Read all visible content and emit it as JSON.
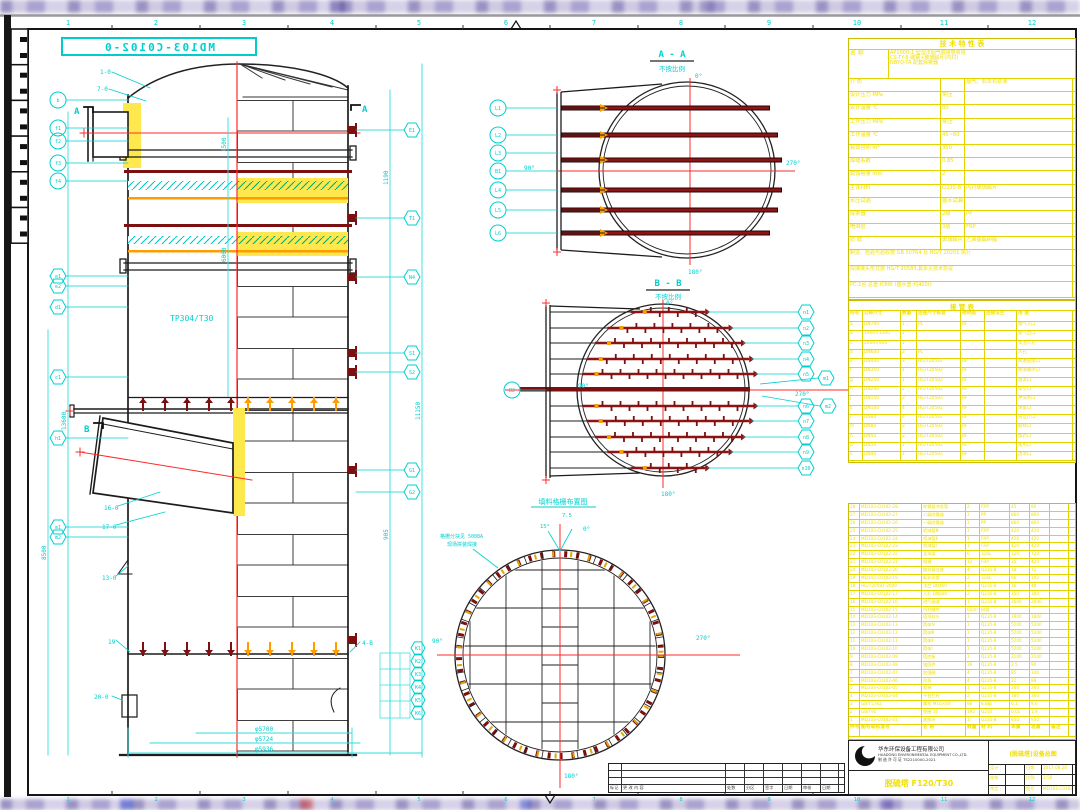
{
  "sheet": {
    "stamp": "MD103-C0102-0",
    "grid_numbers": [
      "1",
      "2",
      "3",
      "4",
      "5",
      "6",
      "7",
      "8",
      "9",
      "10",
      "11",
      "12"
    ]
  },
  "tower": {
    "material_label": "TP304/T30",
    "mark_a": "A",
    "mark_b": "B",
    "callouts": {
      "c10": "1-0",
      "c70": "7-0",
      "c16": "16-0",
      "c17": "17-0",
      "c13": "13-0",
      "c20": "20-0",
      "c19": "19",
      "c4b": "4-B"
    },
    "dims": {
      "d1": "φ5700",
      "d2": "φ5724",
      "d3": "φ5936",
      "l1": "1500",
      "l2": "6000",
      "l3": "8500",
      "l4": "13600",
      "r1": "1190",
      "r2": "11150",
      "r3": "905"
    },
    "left_balloons": [
      "b",
      "f1",
      "f2",
      "f3",
      "f4",
      "e1",
      "e2",
      "d1",
      "c1",
      "h1",
      "m1",
      "m2"
    ],
    "right_balloons": [
      "E1",
      "T1",
      "N4",
      "S1",
      "S2",
      "G1",
      "G2"
    ],
    "bottom_balloons": [
      "K1",
      "K2",
      "K3",
      "K4",
      "K5",
      "K6"
    ]
  },
  "aa": {
    "title": "A - A",
    "subtitle": "不按比例",
    "a0": "0°",
    "a90": "90°",
    "a180": "180°",
    "a270": "270°",
    "balloons": [
      "L1",
      "L2",
      "L3",
      "B1",
      "L4",
      "L5",
      "L6"
    ]
  },
  "bb": {
    "title": "B - B",
    "subtitle": "不按比例",
    "a0": "0°",
    "a90": "90°",
    "a180": "180°",
    "a270": "270°",
    "left_balloon": "B2",
    "balloons": [
      "n1",
      "n2",
      "n3",
      "n4",
      "n5",
      "n6",
      "n7",
      "n8",
      "n9",
      "n10"
    ],
    "side_balloons": [
      "m1",
      "m2"
    ]
  },
  "plan": {
    "title": "填料格栅布置图",
    "a0": "0°",
    "a90": "90°",
    "a180": "180°",
    "a270": "270°",
    "a15": "15°",
    "a75": "7.5",
    "note1": "格栅分块见 5008A",
    "note2": "现场拼装焊接"
  },
  "spec": {
    "title": "技 术 特 性 表",
    "name_label": "名 称",
    "name_lines": [
      "AP1000-1 型湿法烟气脱硫吸收塔",
      "CS-TY-8 碳钢+玻璃鳞片(内衬)",
      "NBYQ-TA 配套除雾器"
    ],
    "rows": [
      [
        "介 质",
        "",
        "烟气、石灰石浆液"
      ],
      [
        "设计压力 MPa",
        "常压",
        ""
      ],
      [
        "设计温度 ℃",
        "80",
        ""
      ],
      [
        "工作压力 MPa",
        "常压",
        ""
      ],
      [
        "工作温度 ℃",
        "45~60",
        ""
      ],
      [
        "有效容积 m³",
        "350",
        ""
      ],
      [
        "焊缝系数",
        "0.85",
        ""
      ],
      [
        "腐蚀裕量 mm",
        "2",
        ""
      ],
      [
        "主体材料",
        "Q235-B",
        "内衬玻璃鳞片"
      ],
      [
        "水压试验",
        "盛水试漏",
        ""
      ],
      [
        "除雾器",
        "2级",
        "PP"
      ],
      [
        "喷淋层",
        "3层",
        "FRP"
      ],
      [
        "防 腐",
        "玻璃鳞片",
        "乙烯基酯树脂"
      ]
    ],
    "footers": [
      "制造、检验与验收按 GB 50764 及 HG/T 20201 执行",
      "焊接接头形式按 HG/T 20583,其余见技术协议",
      "PC:1台  总重:约86t  (盛水重:约420t)"
    ]
  },
  "noz": {
    "title": "接 管 表",
    "headers": [
      "符号",
      "公称尺寸",
      "数量",
      "连接尺寸标准",
      "密封面",
      "连接法兰",
      "用 途"
    ],
    "rows": [
      [
        "a",
        "DN700",
        "1",
        "PL",
        "RF",
        "",
        "烟气入口"
      ],
      [
        "b",
        "1900×1300",
        "1",
        "",
        "",
        "",
        "烟气出口"
      ],
      [
        "c",
        "2000×900",
        "1",
        "",
        "",
        "",
        "浆池人孔"
      ],
      [
        "d",
        "DN600",
        "2",
        "PL",
        "",
        "",
        "人孔"
      ],
      [
        "e",
        "DN400",
        "3",
        "HG/T20592",
        "RF",
        "",
        "喷淋层接口"
      ],
      [
        "f",
        "DN350",
        "1",
        "HG/T20592",
        "RF",
        "",
        "浆液循环口"
      ],
      [
        "g",
        "DN250",
        "1",
        "HG/T20592",
        "RF",
        "",
        "溢流口"
      ],
      [
        "h",
        "DN200",
        "2",
        "HG/T20592",
        "RF",
        "",
        "排空口"
      ],
      [
        "j",
        "DN150",
        "2",
        "HG/T20592",
        "RF",
        "",
        "冲洗水口"
      ],
      [
        "k",
        "DN100",
        "4",
        "HG/T20592",
        "RF",
        "",
        "测量口"
      ],
      [
        "l",
        "DN80",
        "4",
        "HG/T20592",
        "RF",
        "",
        "液位计口"
      ],
      [
        "m",
        "DN80",
        "2",
        "HG/T20592",
        "RF",
        "",
        "取样口"
      ],
      [
        "n",
        "DN50",
        "2",
        "HG/T20592",
        "RF",
        "",
        "加药口"
      ],
      [
        "p",
        "DN50",
        "1",
        "HG/T20592",
        "RF",
        "",
        "备用口"
      ],
      [
        "s",
        "DN40",
        "1",
        "HG/T20592",
        "RF",
        "",
        "放净口"
      ]
    ]
  },
  "bom": {
    "headers": [
      "件号",
      "图号或标准号",
      "名 称",
      "数量",
      "材 料",
      "单重",
      "总重",
      "备注"
    ],
    "rows": [
      [
        "28",
        "MD103-C0102-28",
        "除雾器冲洗管",
        "2",
        "FRP",
        "45",
        "90",
        ""
      ],
      [
        "27",
        "MD103-C0102-27",
        "二级除雾器",
        "1",
        "PP",
        "860",
        "860",
        ""
      ],
      [
        "26",
        "MD103-C0102-26",
        "一级除雾器",
        "1",
        "PP",
        "860",
        "860",
        ""
      ],
      [
        "25",
        "MD103-C0102-25",
        "喷淋管Ⅲ",
        "1",
        "FRP",
        "420",
        "420",
        ""
      ],
      [
        "24",
        "MD103-C0102-24",
        "喷淋管Ⅱ",
        "1",
        "FRP",
        "420",
        "420",
        ""
      ],
      [
        "23",
        "MD103-C0102-23",
        "喷淋管Ⅰ",
        "1",
        "FRP",
        "420",
        "420",
        ""
      ],
      [
        "22",
        "MD103-C0102-22",
        "支承梁",
        "6",
        "316L",
        "120",
        "720",
        ""
      ],
      [
        "21",
        "MD103-C0102-21",
        "格栅",
        "12",
        "FRP",
        "35",
        "420",
        ""
      ],
      [
        "20",
        "MD103-C0102-20",
        "搅拌器支座",
        "4",
        "Q235-B",
        "18",
        "72",
        ""
      ],
      [
        "19",
        "MD103-C0102-19",
        "氧化风管",
        "2",
        "316L",
        "96",
        "192",
        ""
      ],
      [
        "18",
        "HG/T20592-2009",
        "法兰 DN400",
        "3",
        "Q235-B",
        "16",
        "48",
        ""
      ],
      [
        "17",
        "MD103-C0102-17",
        "人孔 DN600",
        "2",
        "Q235-B",
        "150",
        "300",
        ""
      ],
      [
        "16",
        "MD103-C0102-16",
        "进气烟道",
        "1",
        "Q235-B",
        "2600",
        "2600",
        ""
      ],
      [
        "15",
        "MD103-C0102-15",
        "内衬鳞片",
        "65m²",
        "树脂",
        "",
        "",
        ""
      ],
      [
        "14",
        "MD103-C0102-14",
        "塔顶封头",
        "1",
        "Q235-B",
        "1800",
        "1800",
        ""
      ],
      [
        "13",
        "MD103-C0102-13",
        "筒体Ⅳ",
        "1",
        "Q235-B",
        "5200",
        "5200",
        ""
      ],
      [
        "12",
        "MD103-C0102-12",
        "筒体Ⅲ",
        "1",
        "Q235-B",
        "5200",
        "5200",
        ""
      ],
      [
        "11",
        "MD103-C0102-11",
        "筒体Ⅱ",
        "1",
        "Q235-B",
        "5200",
        "5200",
        ""
      ],
      [
        "10",
        "MD103-C0102-10",
        "筒体Ⅰ",
        "1",
        "Q235-B",
        "5200",
        "5200",
        ""
      ],
      [
        "9",
        "MD103-C0102-09",
        "塔底板",
        "1",
        "Q235-B",
        "2100",
        "2100",
        ""
      ],
      [
        "8",
        "MD103-C0102-08",
        "锚固件",
        "36",
        "Q235-B",
        "2.5",
        "90",
        ""
      ],
      [
        "7",
        "MD103-C0102-07",
        "加强圈",
        "4",
        "Q235-B",
        "85",
        "340",
        ""
      ],
      [
        "6",
        "MD103-C0102-06",
        "吊耳",
        "4",
        "Q235-B",
        "22",
        "88",
        ""
      ],
      [
        "5",
        "MD103-C0102-05",
        "爬梯",
        "1",
        "Q235-B",
        "260",
        "260",
        ""
      ],
      [
        "4",
        "MD103-C0102-04",
        "平台栏杆",
        "2",
        "Q235-B",
        "180",
        "360",
        ""
      ],
      [
        "3",
        "GB/T5782",
        "螺栓 M16×60",
        "96",
        "8.8级",
        "0.1",
        "9.6",
        ""
      ],
      [
        "2",
        "GB/T95",
        "垫圈 16",
        "192",
        "Q235",
        "0.01",
        "1.9",
        ""
      ],
      [
        "1",
        "MD103-C0102-01",
        "底座环",
        "1",
        "Q235-B",
        "950",
        "950",
        ""
      ]
    ]
  },
  "tb": {
    "company_cn": "华东环保设备工程有限公司",
    "company_en": "HUADONG ENVIRONMENTAL EQUIPMENT CO.,LTD.",
    "company_lic": "制 造 许 可 证 TS2210000-2021",
    "product": "脱硫塔 F120/T30",
    "dwg_title": "(脱硫塔)设备总图",
    "fields": [
      [
        "设计",
        "",
        "日期",
        "2017.08.28"
      ],
      [
        "校核",
        "",
        "比例",
        "1:50"
      ],
      [
        "审定",
        "",
        "图号",
        "MD103-C0102-0"
      ]
    ]
  },
  "rev": {
    "cells": [
      "标记",
      "更 改 内 容",
      "处数",
      "分区",
      "签字",
      "日期",
      "审核",
      "日期"
    ]
  }
}
